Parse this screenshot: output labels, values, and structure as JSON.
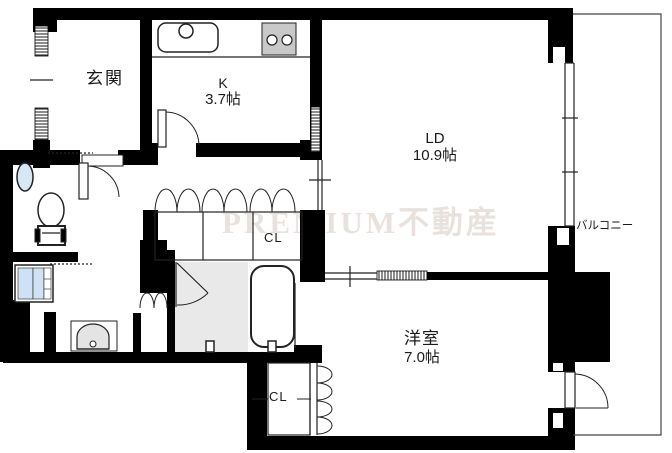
{
  "floorplan": {
    "watermark": "PREMIUM不動産",
    "rooms": {
      "entrance": {
        "label": "玄関"
      },
      "kitchen": {
        "label": "K",
        "size": "3.7帖"
      },
      "living_dining": {
        "label": "LD",
        "size": "10.9帖"
      },
      "bedroom": {
        "label": "洋室",
        "size": "7.0帖"
      },
      "balcony": {
        "label": "バルコニー"
      },
      "hall_closet": {
        "label": "CL"
      },
      "bedroom_closet": {
        "label": "CL"
      }
    },
    "colors": {
      "wall": "#000000",
      "bath_floor": "#e9e9e9",
      "stove": "#c9c9c9",
      "water_fixture": "#cfe2f3",
      "watermark": "#e9e2dc"
    }
  }
}
